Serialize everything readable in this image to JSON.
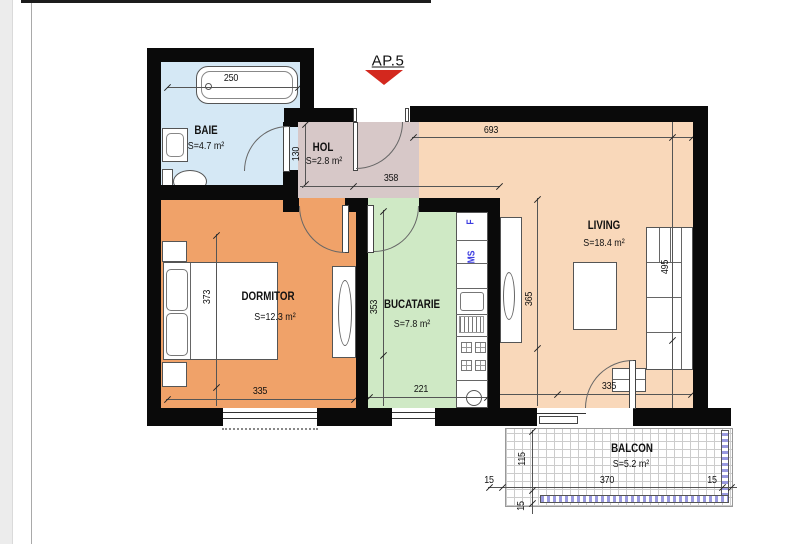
{
  "apartment_label": "AP.5",
  "rooms": {
    "baie": {
      "name": "BAIE",
      "area": "S=4.7 m²"
    },
    "hol": {
      "name": "HOL",
      "area": "S=2.8 m²"
    },
    "dormitor": {
      "name": "DORMITOR",
      "area": "S=12.3 m²"
    },
    "bucatarie": {
      "name": "BUCATARIE",
      "area": "S=7.8 m²"
    },
    "living": {
      "name": "LIVING",
      "area": "S=18.4 m²"
    },
    "balcon": {
      "name": "BALCON",
      "area": "S=5.2 m²"
    }
  },
  "appliances": {
    "fridge_label": "F",
    "washer_label": "MS"
  },
  "dimensions": {
    "bathtub_width": "250",
    "hol_depth": "130",
    "hol_width": "358",
    "living_top_width": "693",
    "living_right_height": "495",
    "living_mid_height": "365",
    "living_window_width": "335",
    "dormitor_height": "373",
    "dormitor_window_width": "335",
    "bucatarie_height": "353",
    "bucatarie_width": "221",
    "balcon_side_left": "15",
    "balcon_width": "370",
    "balcon_side_right": "15",
    "balcon_depth": "115",
    "balcon_edge": "15"
  },
  "colors": {
    "wall": "#0a0a0a",
    "baie": "#d5e8f5",
    "hol": "#d7c8c8",
    "dormitor": "#f0a269",
    "bucatarie": "#cfe9c5",
    "living": "#f9d8ba",
    "marker_red": "#d3281e",
    "appliance_blue": "#3d3de0",
    "balcony_grid": "#cccccc",
    "railing_blue": "#9a9ae0"
  }
}
